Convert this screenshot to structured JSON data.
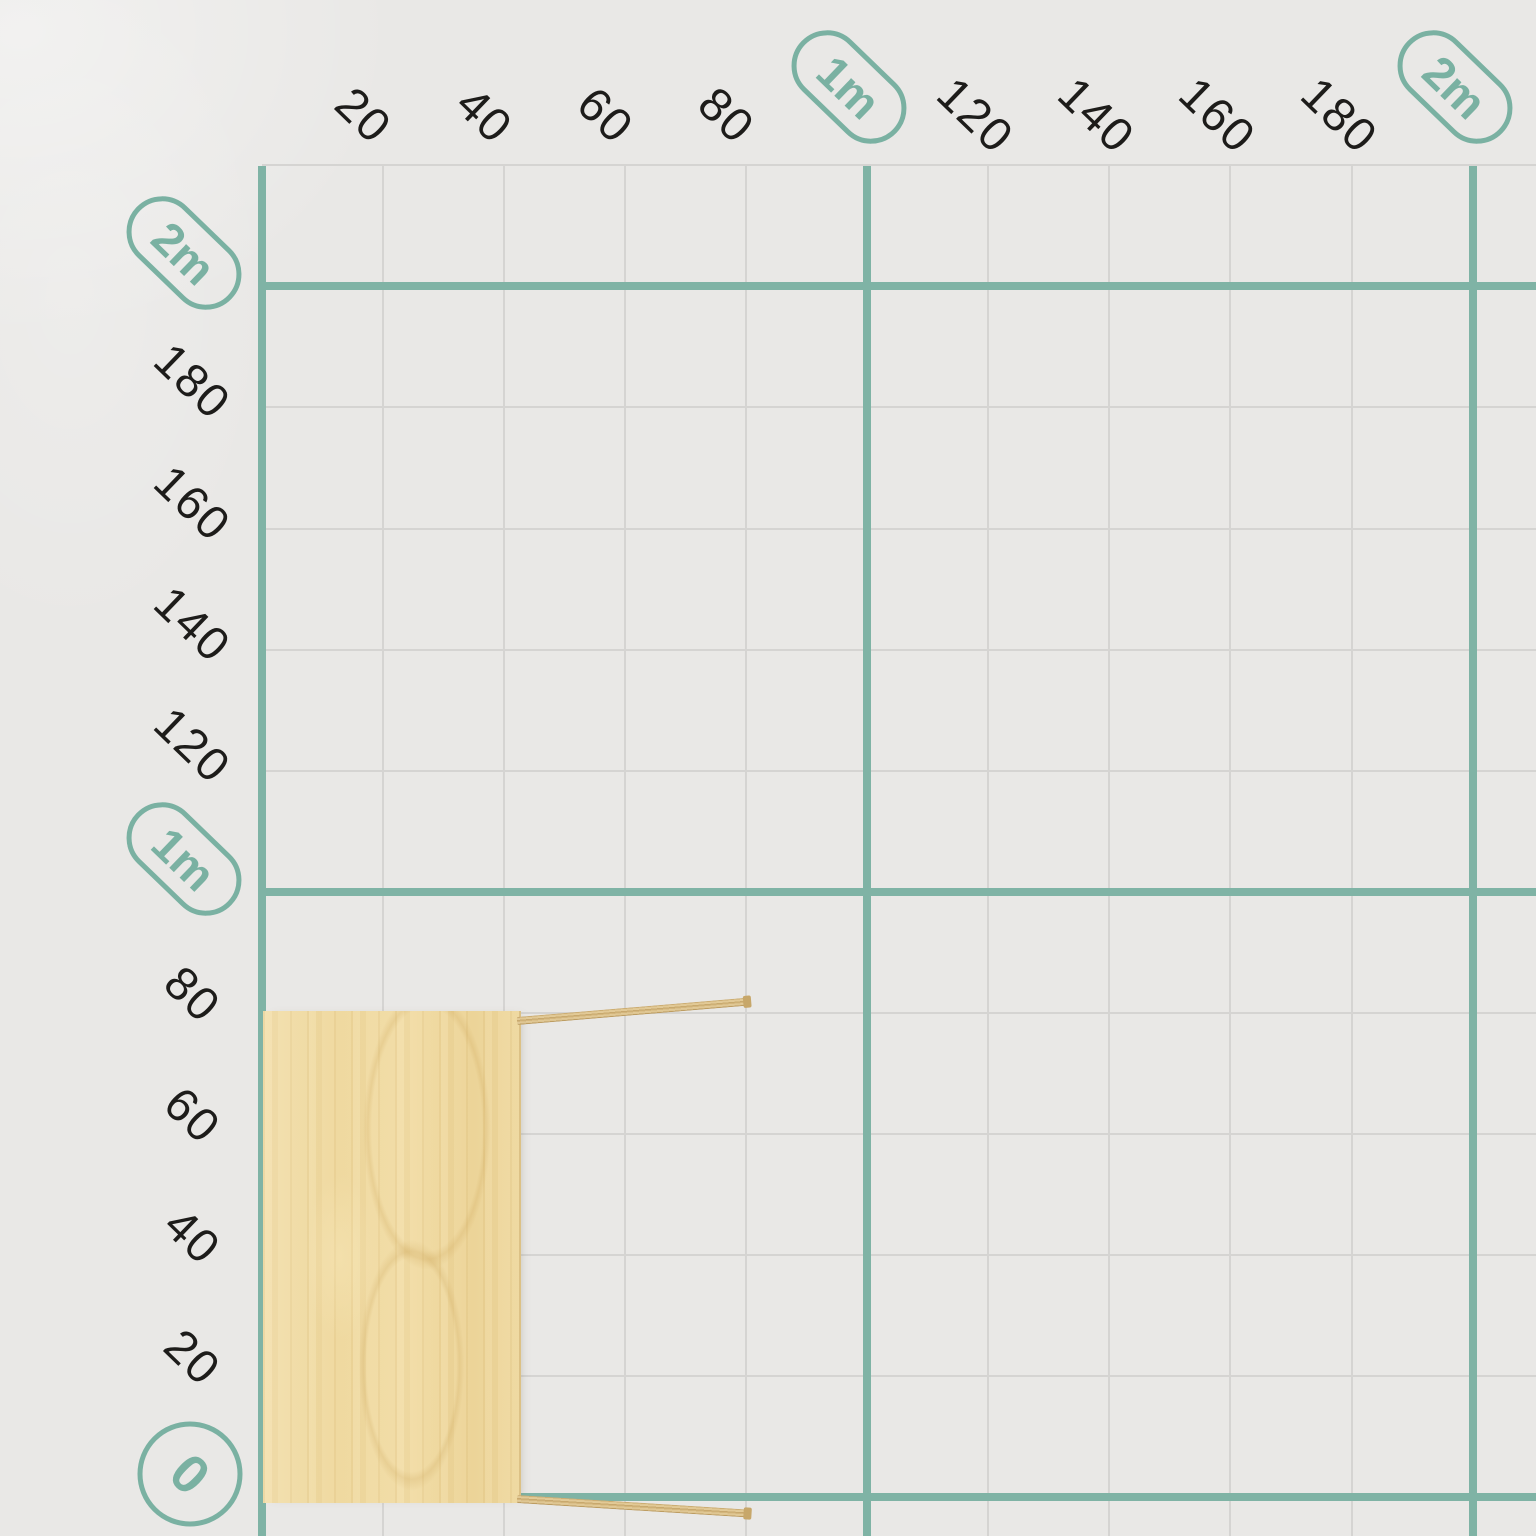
{
  "canvas": {
    "background_color": "#e9e8e6",
    "grid": {
      "step_cm": 20,
      "major_every_cm": 100,
      "x_lines_cm": {
        "from": 0,
        "to": 200
      },
      "y_lines_cm": {
        "from": 0,
        "to": 220
      },
      "minor_color": "#d5d4d2",
      "major_color": "#7fb3a5"
    },
    "x_axis_ticks": [
      {
        "cm": 20,
        "label": "20",
        "style": "number"
      },
      {
        "cm": 40,
        "label": "40",
        "style": "number"
      },
      {
        "cm": 60,
        "label": "60",
        "style": "number"
      },
      {
        "cm": 80,
        "label": "80",
        "style": "number"
      },
      {
        "cm": 100,
        "label": "1m",
        "style": "pill"
      },
      {
        "cm": 120,
        "label": "120",
        "style": "number"
      },
      {
        "cm": 140,
        "label": "140",
        "style": "number"
      },
      {
        "cm": 160,
        "label": "160",
        "style": "number"
      },
      {
        "cm": 180,
        "label": "180",
        "style": "number"
      },
      {
        "cm": 200,
        "label": "2m",
        "style": "pill"
      }
    ],
    "y_axis_ticks": [
      {
        "cm": 0,
        "label": "0",
        "style": "circle"
      },
      {
        "cm": 20,
        "label": "20",
        "style": "number"
      },
      {
        "cm": 40,
        "label": "40",
        "style": "number"
      },
      {
        "cm": 60,
        "label": "60",
        "style": "number"
      },
      {
        "cm": 80,
        "label": "80",
        "style": "number"
      },
      {
        "cm": 100,
        "label": "1m",
        "style": "pill"
      },
      {
        "cm": 120,
        "label": "120",
        "style": "number"
      },
      {
        "cm": 140,
        "label": "140",
        "style": "number"
      },
      {
        "cm": 160,
        "label": "160",
        "style": "number"
      },
      {
        "cm": 180,
        "label": "180",
        "style": "number"
      },
      {
        "cm": 200,
        "label": "2m",
        "style": "pill"
      }
    ],
    "tick_label_color": "#1d1c1a",
    "accent_color": "#7ab1a2"
  },
  "furniture": {
    "kind": "wooden-table-top-view",
    "material": "light-wood",
    "span_cm": {
      "x_from": 0,
      "x_to": 42,
      "y_from": 0,
      "y_to": 81
    },
    "legs_extend_cm": 38,
    "wood_base_color": "#efd9a1",
    "leg_color": "#d3b57b"
  }
}
